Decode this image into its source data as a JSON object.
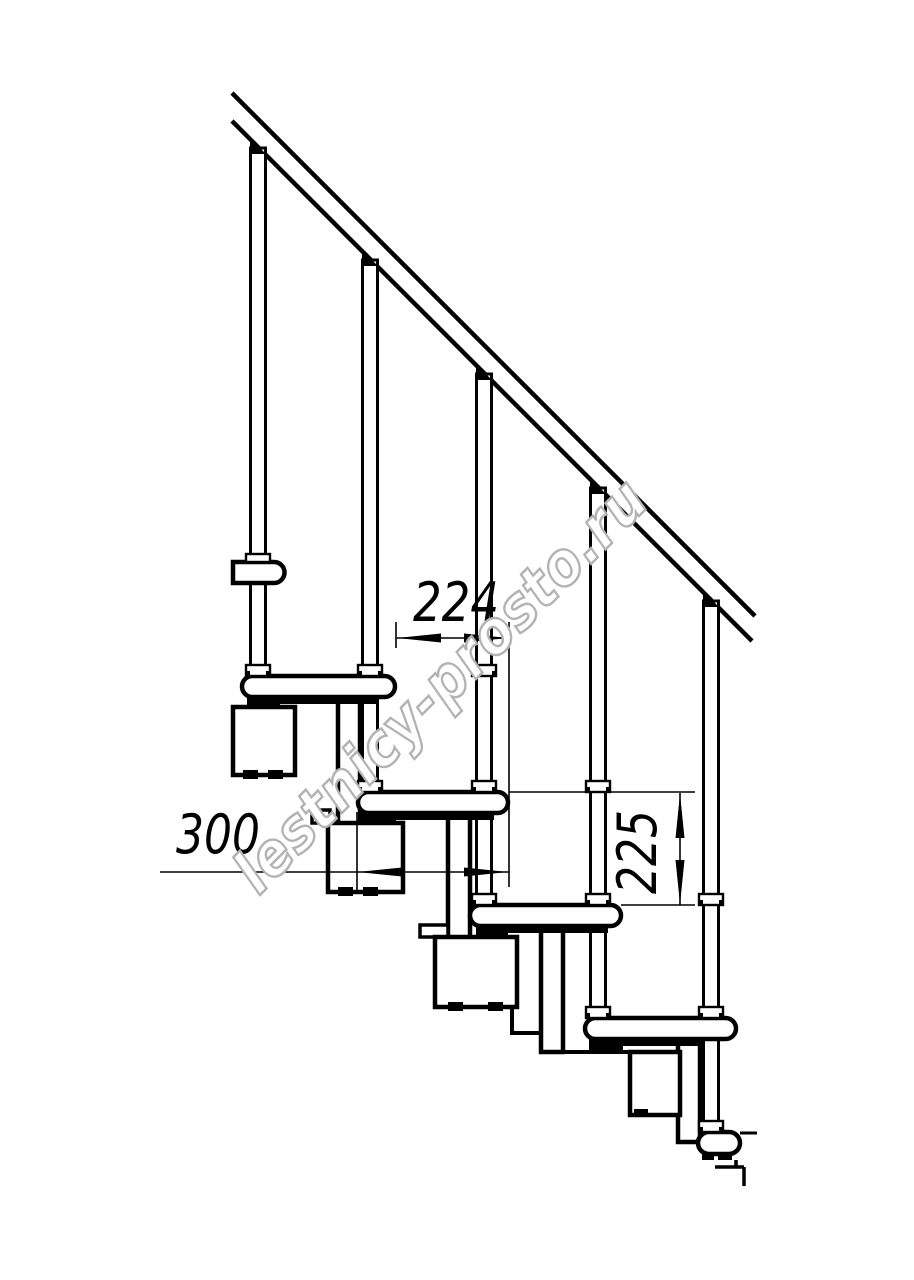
{
  "diagram": {
    "watermark": "lestnicy-prosto.ru",
    "dimensions": {
      "step_run": "224",
      "tread_depth": "300",
      "step_rise": "225"
    },
    "colors": {
      "line": "#000000",
      "background": "#ffffff",
      "watermark_fill": "#ffffff",
      "watermark_stroke": "#b3b3b3"
    }
  }
}
